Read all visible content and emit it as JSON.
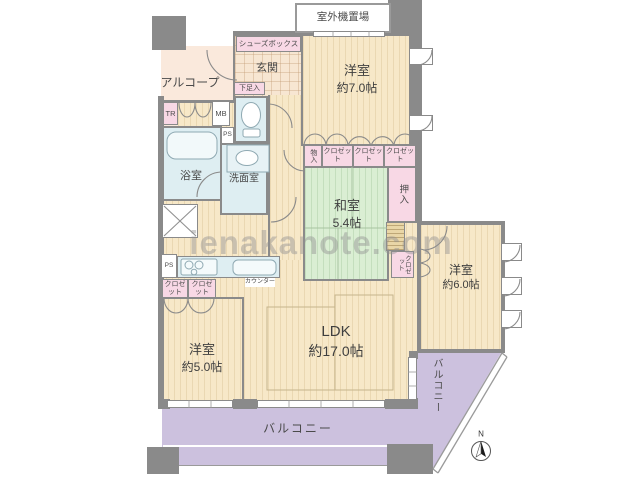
{
  "watermark": "ienakanote.com",
  "compass": {
    "label": "N"
  },
  "areas": {
    "outdoor_unit": "室外機置場",
    "shoes_box": "シューズボックス",
    "entrance": "玄関",
    "alcove": "アルコープ",
    "shoe_cabinet": "下足入",
    "trunk_room": "TR",
    "meter_box": "MB",
    "pipe_space_1": "PS",
    "pipe_space_2": "PS",
    "bathroom": "浴室",
    "washroom": "洗面室",
    "storage_small": "物入",
    "closet_top_1": "クロゼット",
    "closet_top_2": "クロゼット",
    "closet_top_3": "クロゼット",
    "oshiire": "押入",
    "closet_west6": "クロゼット",
    "closet_kitchen_1": "クロゼット",
    "closet_kitchen_2": "クロゼット",
    "counter": "カウンター",
    "balcony_south": "バルコニー",
    "balcony_east": "バルコニー"
  },
  "rooms": {
    "western_7": {
      "name": "洋室",
      "size": "約7.0帖"
    },
    "japanese": {
      "name": "和室",
      "size": "5.4帖"
    },
    "western_6": {
      "name": "洋室",
      "size": "約6.0帖"
    },
    "western_5": {
      "name": "洋室",
      "size": "約5.0帖"
    },
    "ldk": {
      "name": "LDK",
      "size": "約17.0帖"
    }
  },
  "colors": {
    "wall": "#8a8a8a",
    "room_floor": "#f7e8c8",
    "tatami": "#daeed3",
    "wet_area": "#deeef2",
    "closet_pink": "#f8d8e5",
    "balcony": "#ccc1de",
    "alcove": "#fae9dc"
  }
}
